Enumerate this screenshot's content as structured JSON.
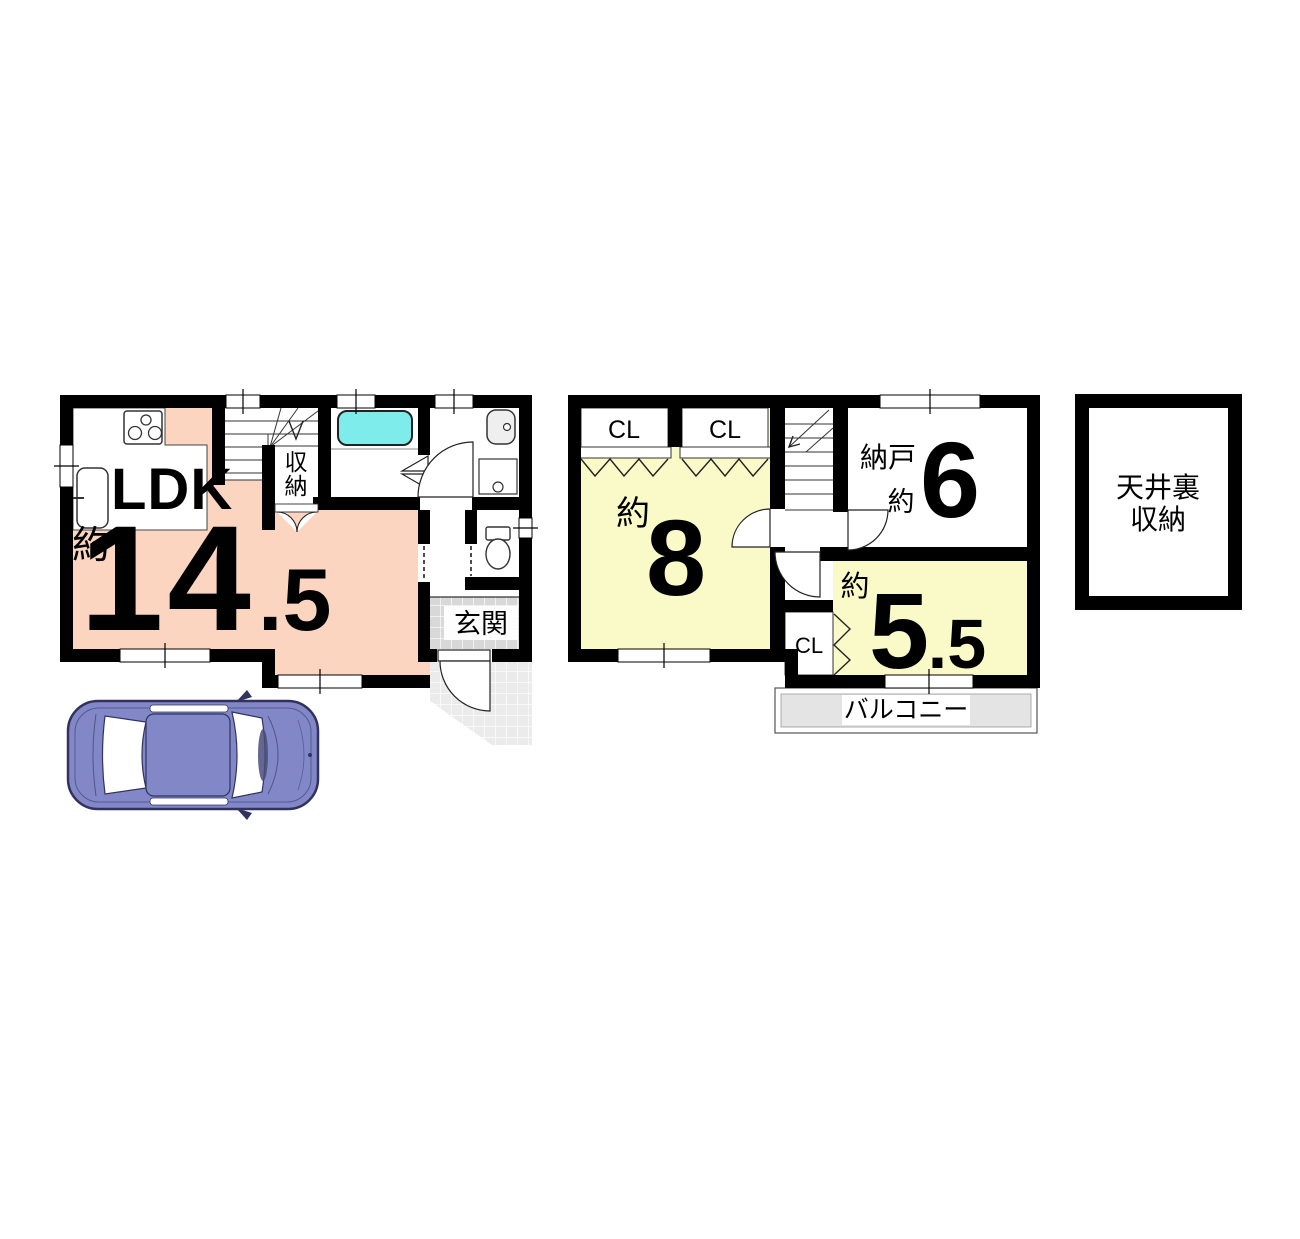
{
  "colors": {
    "wall": "#000000",
    "ldk_fill": "#fcd5c1",
    "room_fill": "#fafac9",
    "tub_fill": "#7fecec",
    "genkan_tile": "#d8d8d8",
    "approach_tile": "#ebebeb",
    "balcony_fill": "#e4e4e4",
    "car_body": "#8287c8",
    "car_outline": "#31335e"
  },
  "floor1": {
    "ldk": {
      "name": "LDK",
      "approx": "約",
      "area_int": "14",
      "area_frac": ".5"
    },
    "closet_char1": "収",
    "closet_char2": "納",
    "entrance": "玄関"
  },
  "floor2": {
    "closet_a": "CL",
    "closet_b": "CL",
    "closet_c": "CL",
    "room8": {
      "approx": "約",
      "area": "8"
    },
    "storeroom": {
      "name": "納戸",
      "approx": "約",
      "area": "6"
    },
    "room55": {
      "approx": "約",
      "area_int": "5",
      "area_frac": ".5"
    },
    "balcony": "バルコニー"
  },
  "attic": {
    "line1": "天井裏",
    "line2": "収納"
  }
}
